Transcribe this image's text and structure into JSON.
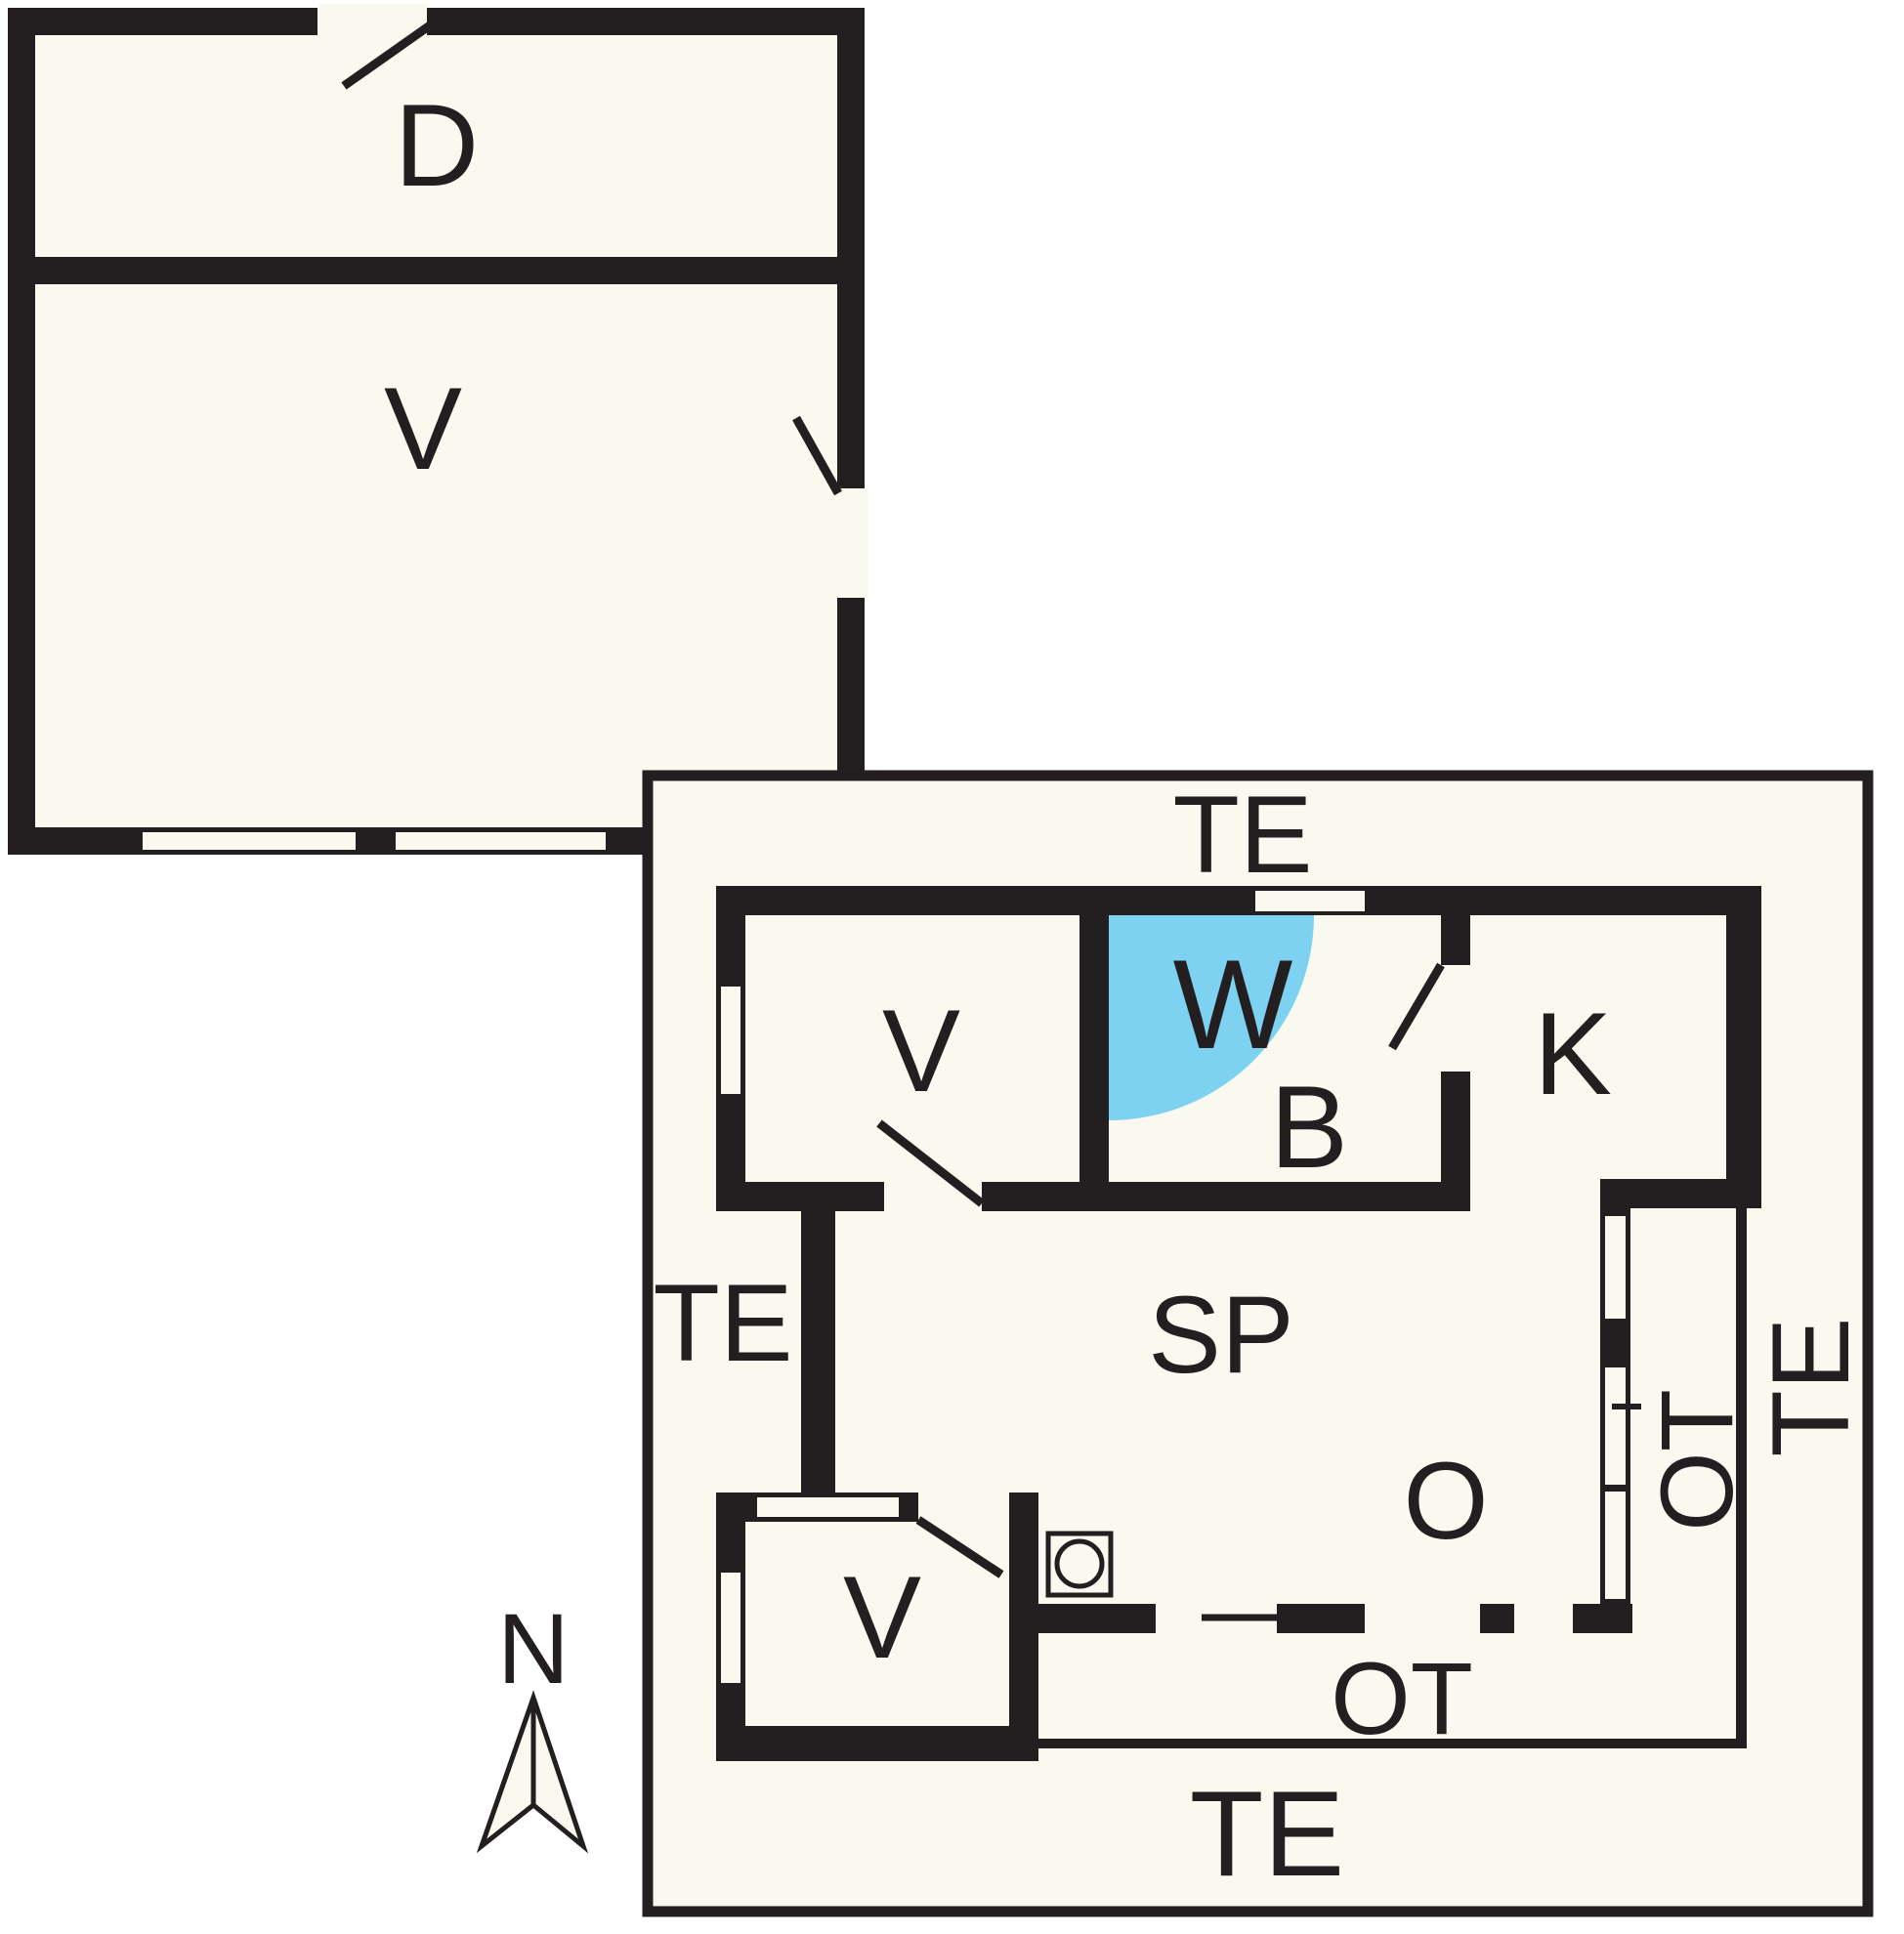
{
  "plan": {
    "title": "floor-plan",
    "colors": {
      "page_background": "#ffffff",
      "floor": "#FAF9F0",
      "wall": "#231F20",
      "door_swing_area": "#7DD2F1"
    },
    "north": {
      "label": "N"
    },
    "upper_building": {
      "rooms": [
        {
          "id": "d",
          "label": "D"
        },
        {
          "id": "v",
          "label": "V"
        }
      ]
    },
    "main_building": {
      "rooms": [
        {
          "id": "v_upper",
          "label": "V"
        },
        {
          "id": "w",
          "label": "W"
        },
        {
          "id": "b",
          "label": "B"
        },
        {
          "id": "k",
          "label": "K"
        },
        {
          "id": "sp",
          "label": "SP"
        },
        {
          "id": "o",
          "label": "O"
        },
        {
          "id": "v_lower",
          "label": "V"
        }
      ],
      "outdoor_areas": [
        {
          "id": "te_top",
          "label": "TE"
        },
        {
          "id": "te_left",
          "label": "TE"
        },
        {
          "id": "te_right",
          "label": "TE"
        },
        {
          "id": "te_bottom",
          "label": "TE"
        },
        {
          "id": "ot_right",
          "label": "OT"
        },
        {
          "id": "ot_bottom",
          "label": "OT"
        }
      ]
    }
  }
}
